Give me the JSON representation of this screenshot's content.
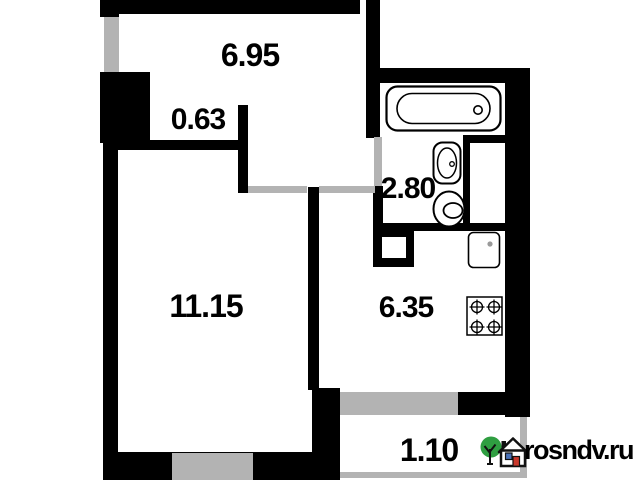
{
  "plan": {
    "type": "apartment-floor-plan",
    "areas": {
      "hallway": "6.95",
      "niche": "0.63",
      "bathroom": "2.80",
      "room": "11.15",
      "kitchen": "6.35",
      "balcony": "1.10"
    },
    "fixtures": [
      "bathtub",
      "washbasin",
      "toilet",
      "kitchen-sink",
      "stove",
      "vent-shaft"
    ],
    "colors": {
      "wall": "#000000",
      "opening": "#b3b3b3",
      "background": "#ffffff"
    }
  },
  "watermark": {
    "site": "rosndv.ru",
    "icon": "house-and-tree-icon",
    "colors": {
      "tree": "#2f9e41",
      "window": "#4a72b8",
      "door": "#c9382b",
      "text": "#000000"
    }
  }
}
